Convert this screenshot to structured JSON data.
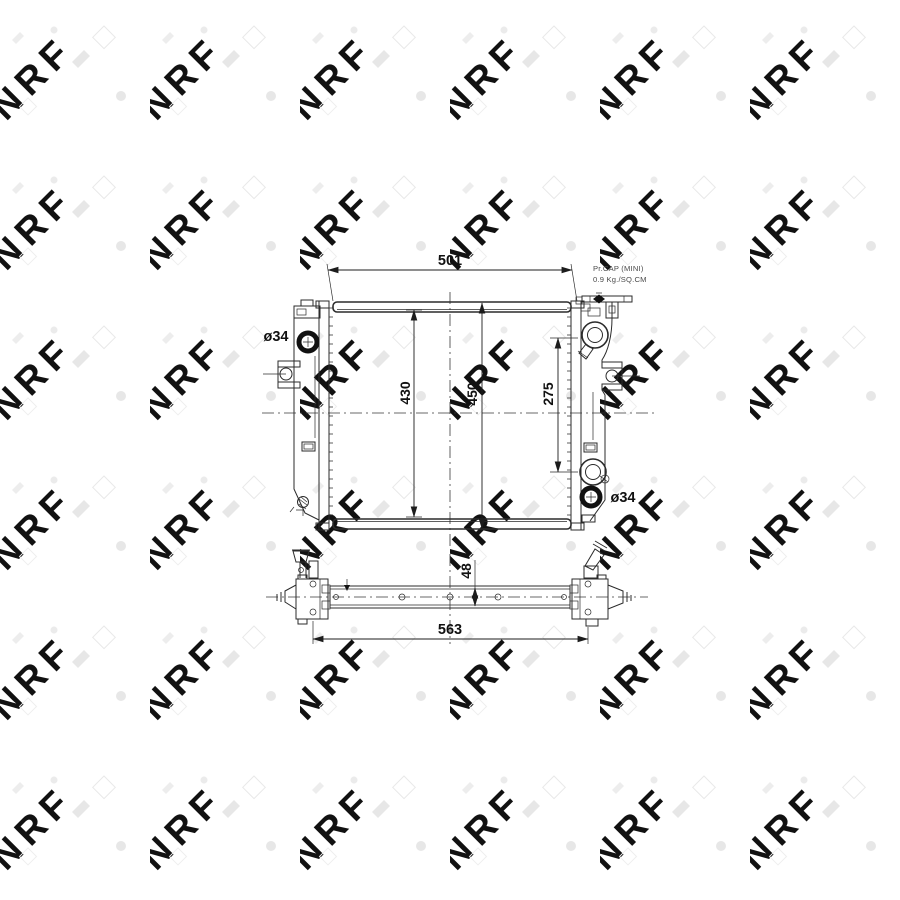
{
  "watermark": {
    "text": "NRF"
  },
  "annotations": {
    "pressure_cap_note_line1": "Pr.CAP (MINI)",
    "pressure_cap_note_line2": "0.9 Kg./SQ.CM"
  },
  "dimensions": {
    "top_width": "501",
    "core_height": "430",
    "overall_height": "450",
    "port_spacing": "275",
    "inlet_diameter_left": "ø34",
    "outlet_diameter_right": "ø34",
    "core_depth": "48",
    "overall_width": "563"
  }
}
